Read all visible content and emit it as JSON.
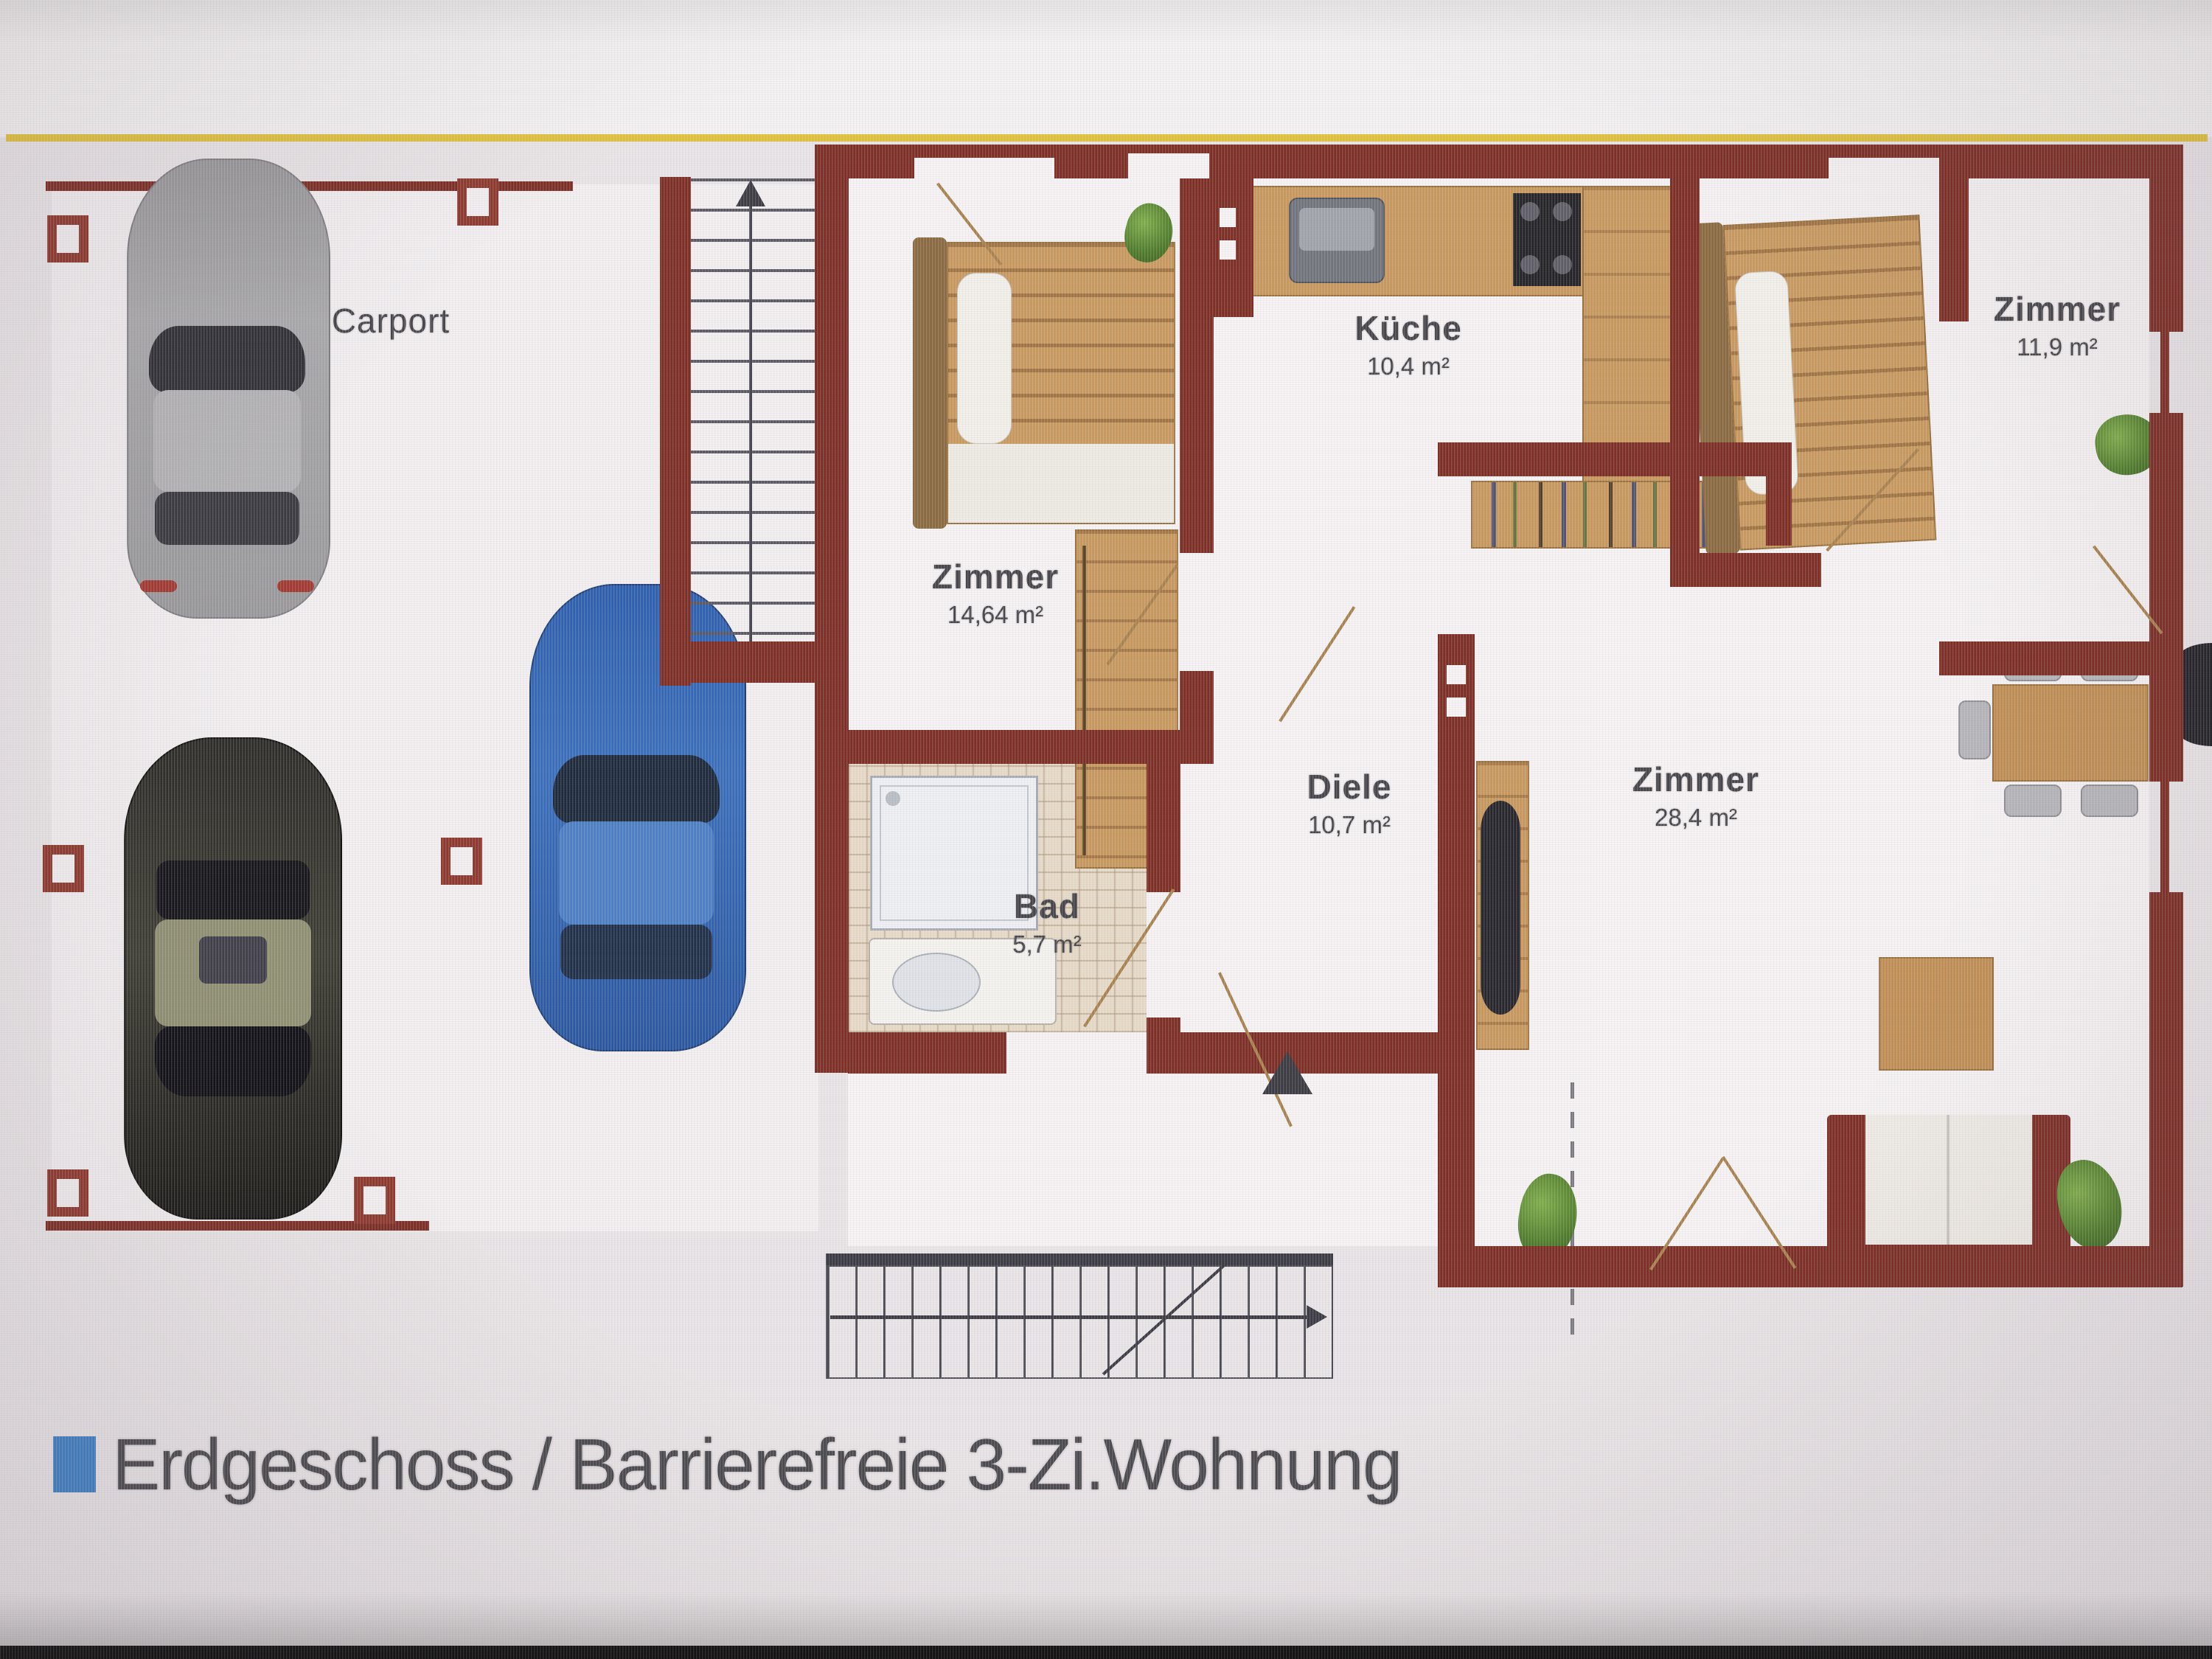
{
  "caption": {
    "text": "Erdgeschoss / Barrierefreie 3-Zi.Wohnung"
  },
  "rooms": [
    {
      "name": "Carport",
      "area": ""
    },
    {
      "name": "Zimmer",
      "area": "14,64 m²"
    },
    {
      "name": "Küche",
      "area": "10,4 m²"
    },
    {
      "name": "Zimmer",
      "area": "11,9 m²"
    },
    {
      "name": "Diele",
      "area": "10,7 m²"
    },
    {
      "name": "Zimmer",
      "area": "28,4 m²"
    },
    {
      "name": "Bad",
      "area": "5,7 m²"
    }
  ],
  "colors": {
    "wall": "#7c2e25",
    "wood": "#c8995e",
    "caption_bullet": "#3f7fc4",
    "stair_lines": "#3b3b44",
    "plant_green": "#5c8f35",
    "top_rule_yellow": "#ddbe2e"
  }
}
